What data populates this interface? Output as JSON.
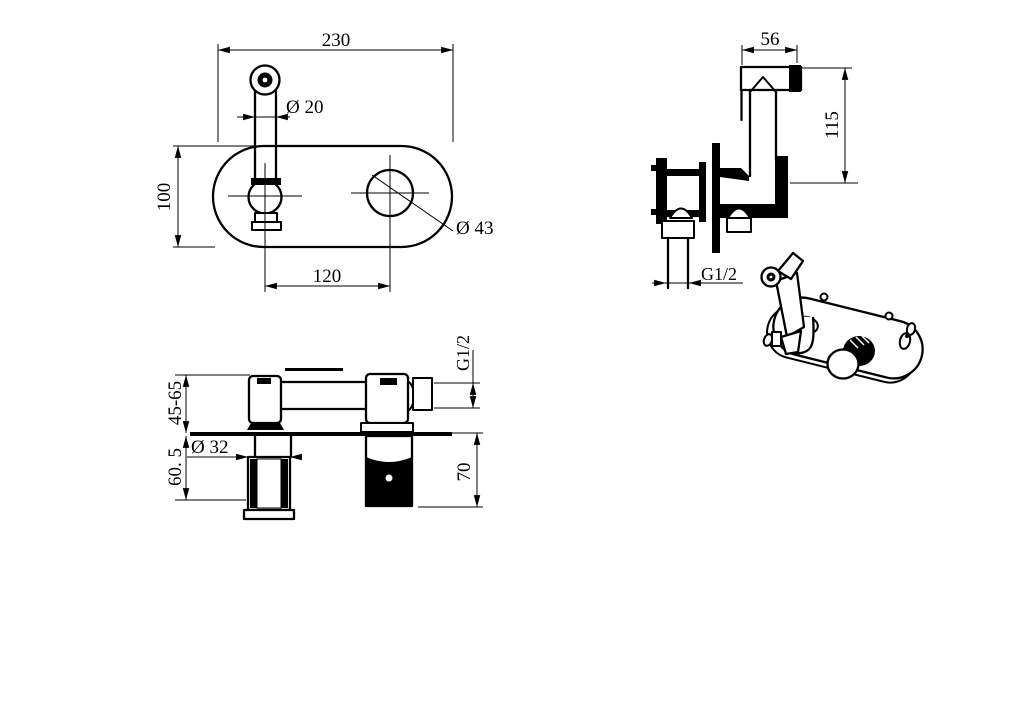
{
  "drawing": {
    "background_color": "#ffffff",
    "line_color": "#000000",
    "views": {
      "front": {
        "dim_plate_width": "230",
        "dim_spout_diameter": "Ø 20",
        "dim_plate_height": "100",
        "dim_hole_diameter": "Ø 43",
        "dim_hole_spacing": "120"
      },
      "side": {
        "dim_head_width": "56",
        "dim_height": "115",
        "dim_inlet_thread": "G1/2"
      },
      "plan": {
        "dim_inlet_thread": "G1/2",
        "dim_wall_depth_range": "45-65",
        "dim_embed_depth": "60. 5",
        "dim_holder_diameter": "Ø 32",
        "dim_valve_depth": "70"
      }
    }
  }
}
